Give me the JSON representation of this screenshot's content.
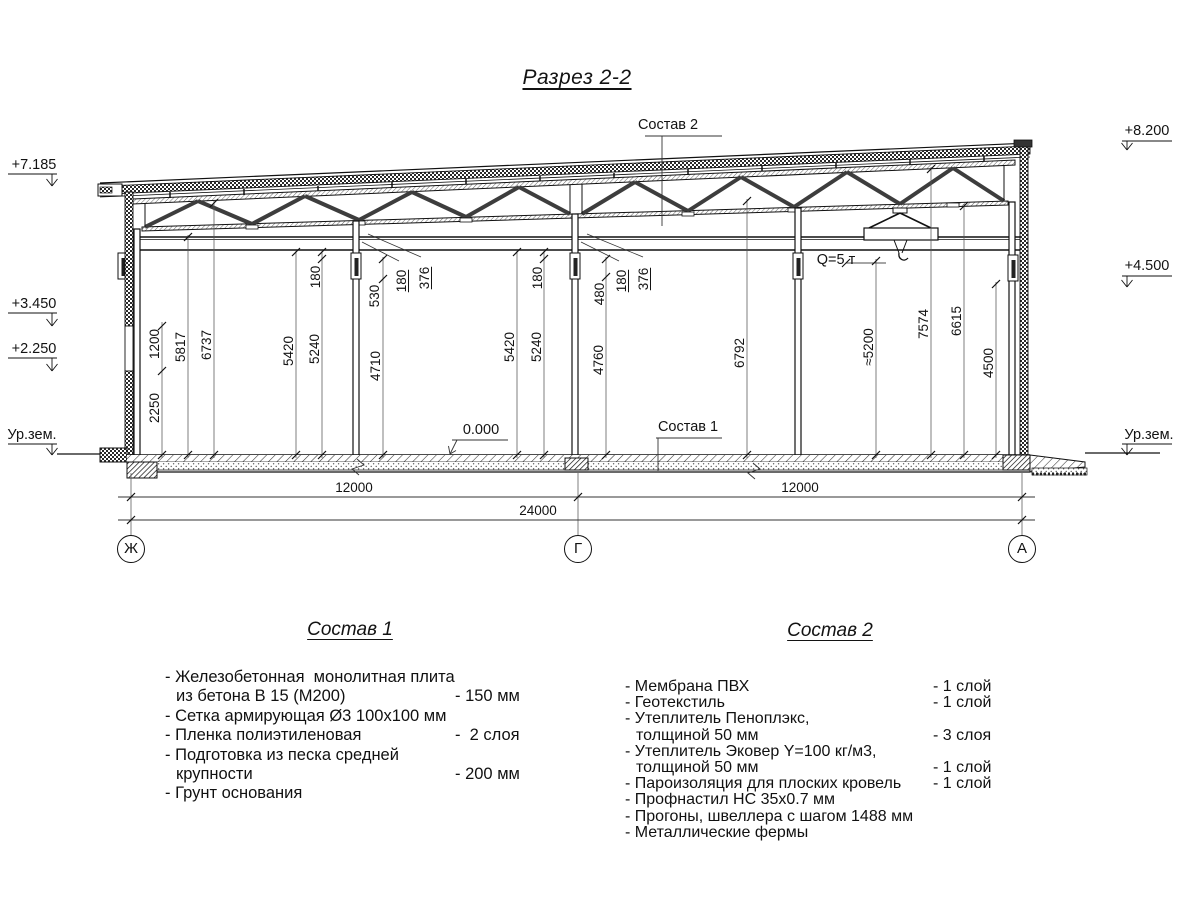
{
  "title": "Разрез 2-2",
  "elevations": {
    "left": [
      "+7.185",
      "+3.450",
      "+2.250",
      "Ур.зем."
    ],
    "right": [
      "+8.200",
      "+4.500",
      "Ур.зем."
    ]
  },
  "callouts": {
    "sostav2_ref": "Состав 2",
    "sostav1_ref": "Состав 1",
    "zero_level": "0.000",
    "crane_capacity": "Q=5 т"
  },
  "vdims": [
    "1200",
    "5817",
    "6737",
    "2250",
    "180",
    "530",
    "180",
    "376",
    "5420",
    "5240",
    "4710",
    "180",
    "480",
    "180",
    "376",
    "5420",
    "5240",
    "4760",
    "6792",
    "≈5200",
    "7574",
    "6615",
    "4500"
  ],
  "hdims": {
    "left_bay": "12000",
    "right_bay": "12000",
    "total": "24000"
  },
  "axes": [
    "Ж",
    "Г",
    "А"
  ],
  "sostav1": {
    "heading": "Состав 1",
    "rows": [
      {
        "text": "- Железобетонная  монолитная плита",
        "value": ""
      },
      {
        "text": "из бетона В 15 (М200)",
        "value": "- 150 мм"
      },
      {
        "text": "- Сетка армирующая Ø3 100х100 мм",
        "value": ""
      },
      {
        "text": "- Пленка полиэтиленовая",
        "value": "-  2 слоя"
      },
      {
        "text": "- Подготовка из песка средней",
        "value": ""
      },
      {
        "text": "крупности",
        "value": "- 200 мм"
      },
      {
        "text": "- Грунт основания",
        "value": ""
      }
    ]
  },
  "sostav2": {
    "heading": "Состав 2",
    "rows": [
      {
        "text": "- Мембрана ПВХ",
        "value": "- 1 слой"
      },
      {
        "text": "- Геотекстиль",
        "value": "- 1 слой"
      },
      {
        "text": "- Утеплитель Пеноплэкс,",
        "value": ""
      },
      {
        "text": "толщиной 50 мм",
        "value": "- 3 слоя"
      },
      {
        "text": "- Утеплитель Эковер Y=100 кг/м3,",
        "value": ""
      },
      {
        "text": "толщиной 50 мм",
        "value": "- 1 слой"
      },
      {
        "text": "- Пароизоляция для плоских кровель",
        "value": "- 1 слой"
      },
      {
        "text": "- Профнастил НС 35х0.7 мм",
        "value": ""
      },
      {
        "text": "- Прогоны, швеллера с шагом 1488 мм",
        "value": ""
      },
      {
        "text": "- Металлические фермы",
        "value": ""
      }
    ]
  }
}
